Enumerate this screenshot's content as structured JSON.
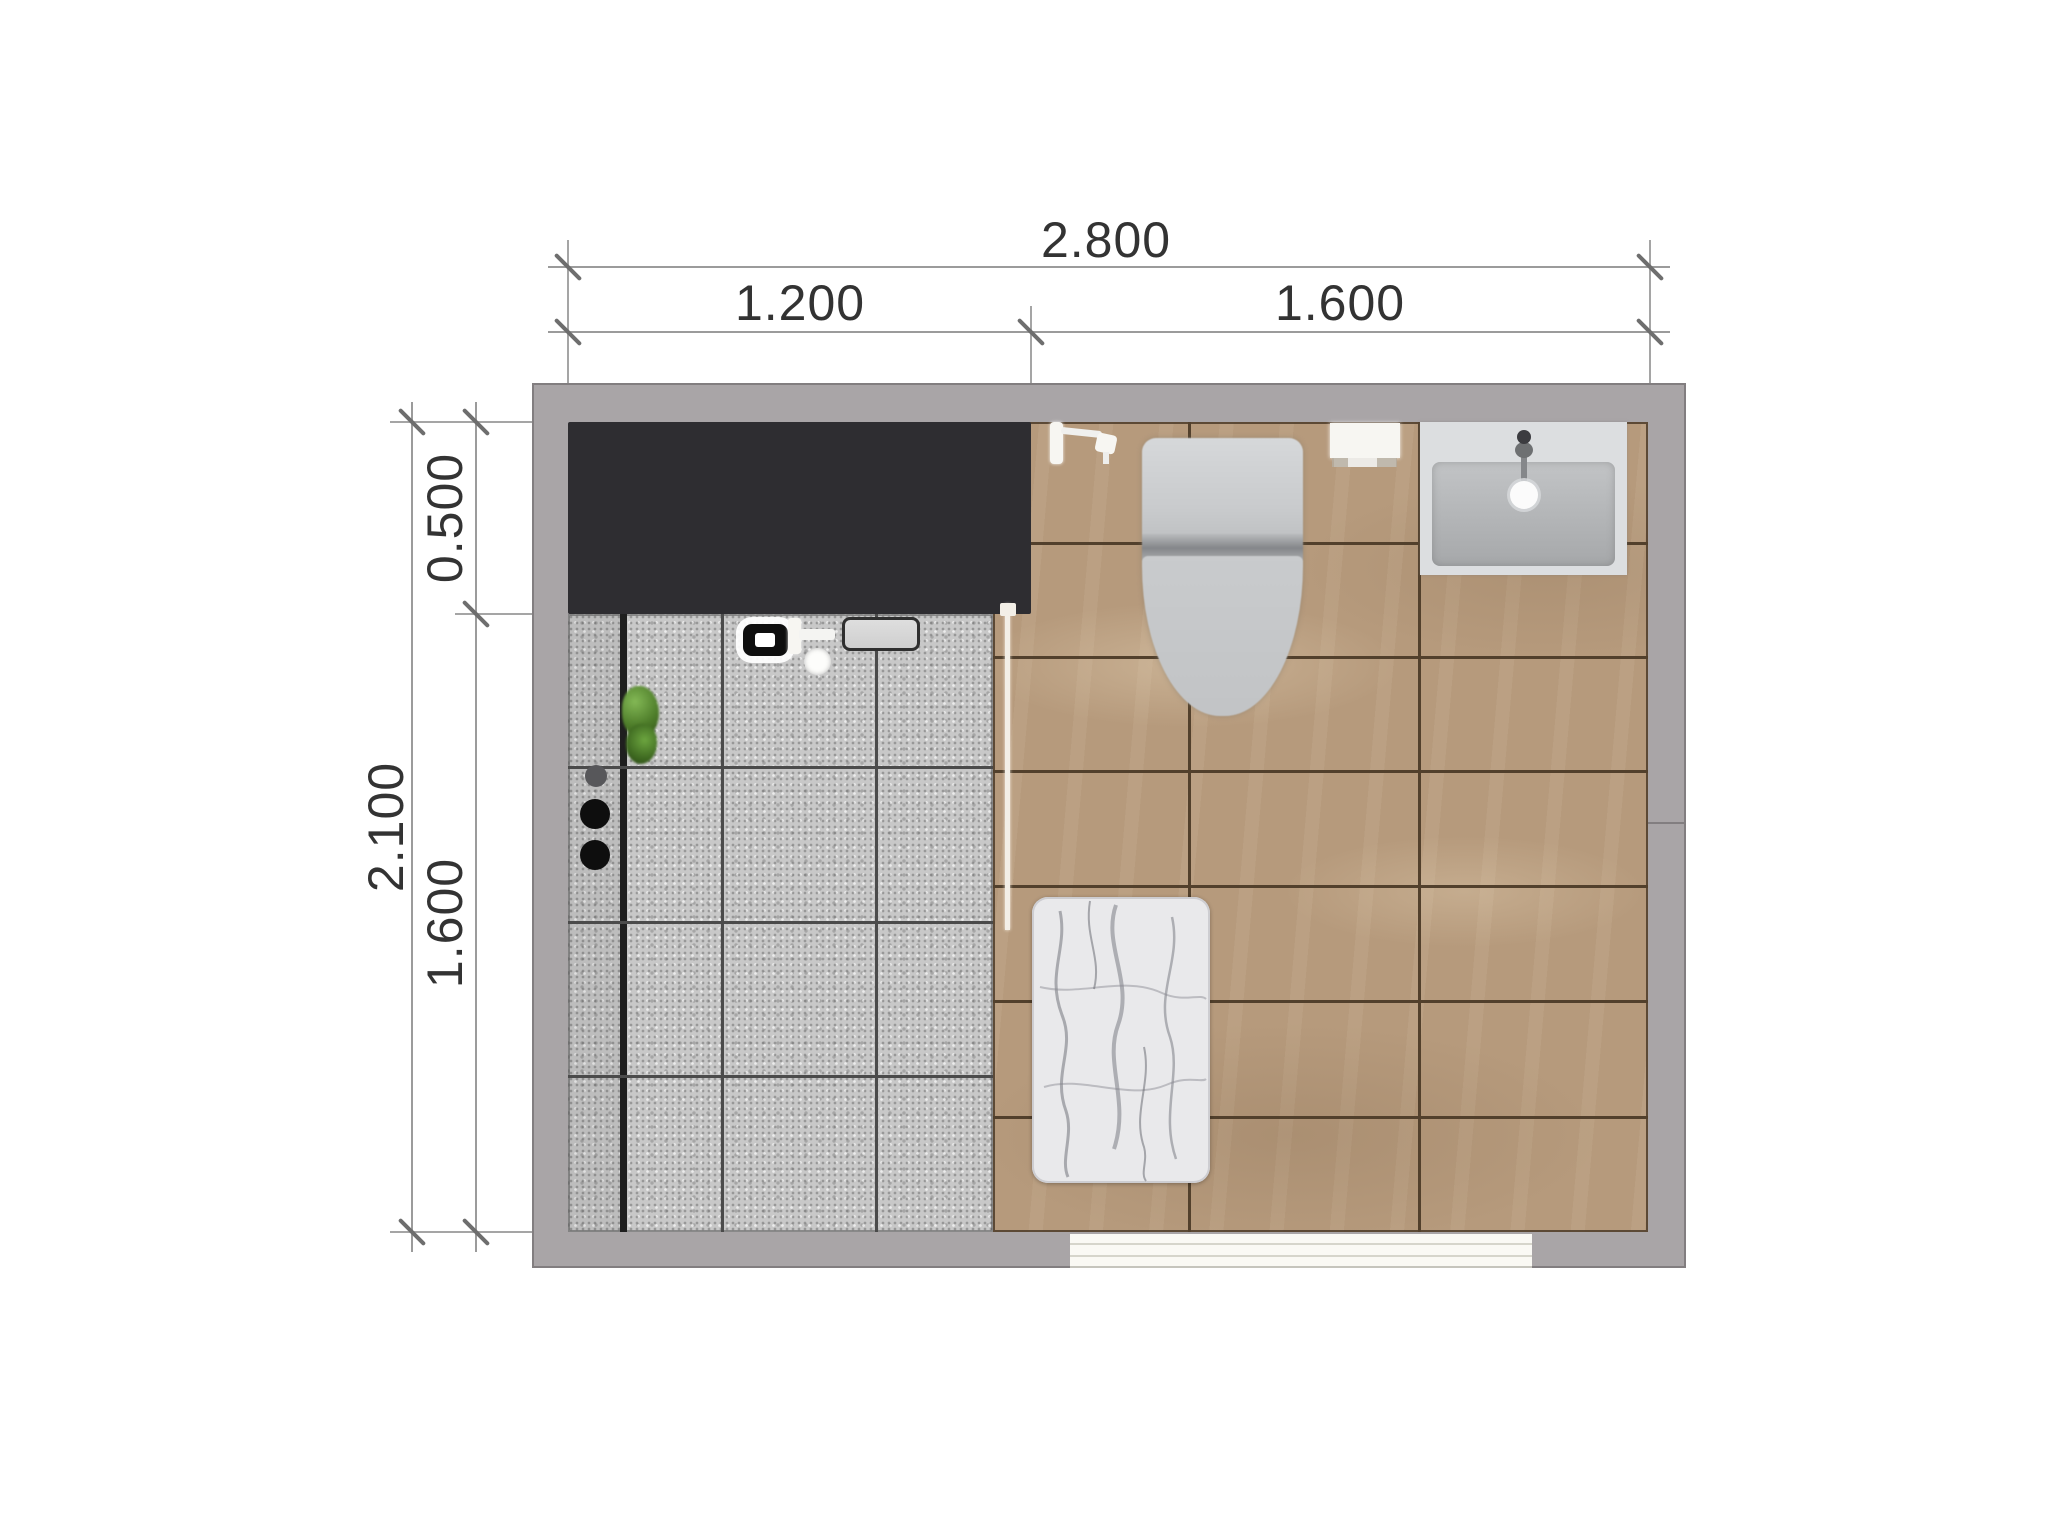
{
  "plan": {
    "type": "bathroom-floor-plan-top-view",
    "dims": {
      "top_total": "2.800",
      "top_left": "1.200",
      "top_right": "1.600",
      "left_total": "2.100",
      "left_top": "0.500",
      "left_bottom": "1.600"
    },
    "fixtures": [
      "vanity-counter",
      "shower-control-panel",
      "shower-mixer",
      "floor-drain",
      "shower-shelf",
      "plant",
      "supply-dots",
      "glass-screen",
      "toilet",
      "hand-shower",
      "wall-cistern-box",
      "washbasin",
      "marble-bath-mat",
      "door-threshold",
      "linear-trench-drain"
    ],
    "colors": {
      "wall": "#a9a5a7",
      "wall_edge": "#827e80",
      "counter": "#2e2d31",
      "tile_gray": "#c8c8c8",
      "tile_gray_grout": "#4b4b4b",
      "trench_line": "#1f1f1f",
      "tile_brown": "#b69a7c",
      "tile_brown_grout": "#52402c",
      "sink_rim": "#dcdee0",
      "fixture_white": "#f7f6f2",
      "glass_white": "#f3efe7",
      "mat_base": "#e9e9eb",
      "mat_vein": "#72747c",
      "door_white": "#faf9f4",
      "door_line": "#d6d5cb",
      "plant_green": "#5d9136",
      "dot_black": "#0e0e0e",
      "dot_gray": "#57575a",
      "dim_line": "#9b9b9b",
      "dim_ext": "#a5a5a5",
      "dim_tick": "#6e6e6e",
      "dim_text": "#333333"
    }
  }
}
